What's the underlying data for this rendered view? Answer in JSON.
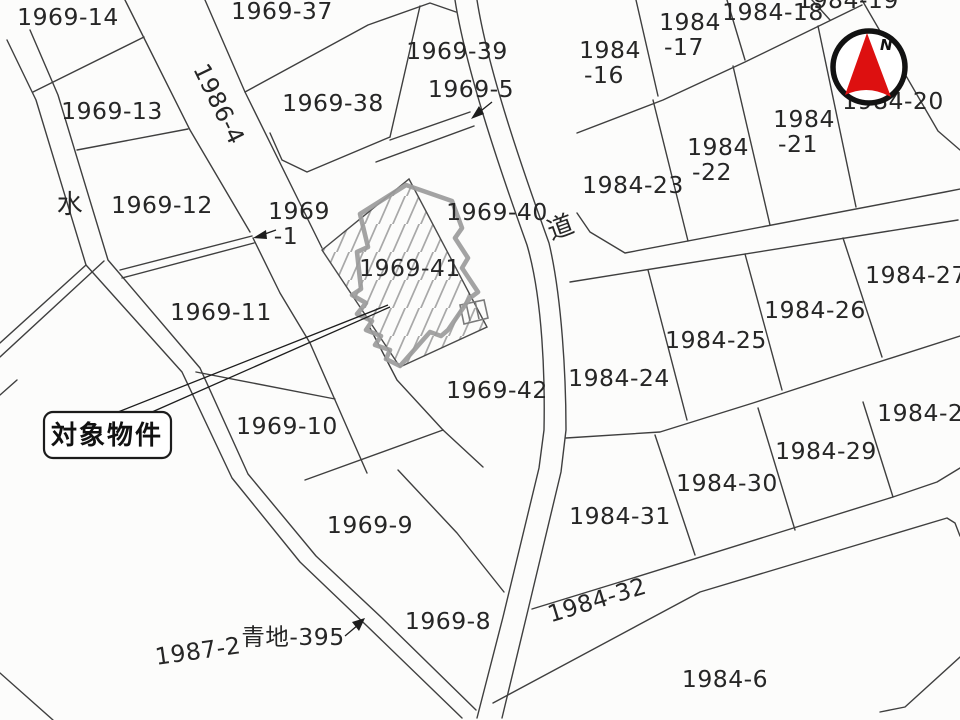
{
  "map": {
    "colors": {
      "background": "#fcfcfb",
      "boundary_line": "#3f3f3f",
      "text": "#262626",
      "property_outline": "#9b9b9b",
      "hatch": "#a8a8a8",
      "compass_ring": "#121212",
      "compass_arrow": "#dd1010"
    },
    "target_parcel": "1969-41",
    "target_callout": {
      "text": "対象物件"
    },
    "compass": {
      "label": "N"
    },
    "labels": [
      {
        "id": "1969-14",
        "text": "1969-14",
        "x": 68,
        "y": 25
      },
      {
        "id": "1969-37",
        "text": "1969-37",
        "x": 282,
        "y": 19
      },
      {
        "id": "1969-39",
        "text": "1969-39",
        "x": 457,
        "y": 59
      },
      {
        "id": "1969-5",
        "text": "1969-5",
        "x": 471,
        "y": 97
      },
      {
        "id": "1984-16",
        "text": "1984\n-16",
        "x": 610,
        "y": 58,
        "dx2": -6
      },
      {
        "id": "1984-17",
        "text": "1984\n-17",
        "x": 690,
        "y": 30,
        "dx2": -6
      },
      {
        "id": "1984-18",
        "text": "1984-18",
        "x": 773,
        "y": 20
      },
      {
        "id": "1984-19",
        "text": "1984-19",
        "x": 848,
        "y": 8
      },
      {
        "id": "1969-13",
        "text": "1969-13",
        "x": 112,
        "y": 119
      },
      {
        "id": "1986-4",
        "text": "1986-4",
        "x": 219,
        "y": 112,
        "rot": 64
      },
      {
        "id": "1969-38",
        "text": "1969-38",
        "x": 333,
        "y": 111
      },
      {
        "id": "1984-23",
        "text": "1984-23",
        "x": 633,
        "y": 193
      },
      {
        "id": "1984-22",
        "text": "1984\n-22",
        "x": 718,
        "y": 155,
        "dx2": -6
      },
      {
        "id": "1984-21",
        "text": "1984\n-21",
        "x": 804,
        "y": 127,
        "dx2": -6
      },
      {
        "id": "1984-20",
        "text": "1984-20",
        "x": 893,
        "y": 109
      },
      {
        "id": "water",
        "text": "水",
        "x": 70,
        "y": 213,
        "size": 27
      },
      {
        "id": "1969-12",
        "text": "1969-12",
        "x": 162,
        "y": 213
      },
      {
        "id": "1969-1",
        "text": "1969\n-1",
        "x": 299,
        "y": 219,
        "dx2": -13
      },
      {
        "id": "1969-40",
        "text": "1969-40",
        "x": 497,
        "y": 220
      },
      {
        "id": "road",
        "text": "道",
        "x": 561,
        "y": 236,
        "rot": -20,
        "size": 24
      },
      {
        "id": "1984-27",
        "text": "1984-27",
        "x": 916,
        "y": 283
      },
      {
        "id": "1984-26",
        "text": "1984-26",
        "x": 815,
        "y": 318
      },
      {
        "id": "1984-25",
        "text": "1984-25",
        "x": 716,
        "y": 348
      },
      {
        "id": "1984-24",
        "text": "1984-24",
        "x": 619,
        "y": 386
      },
      {
        "id": "1969-41",
        "text": "1969-41",
        "x": 410,
        "y": 276
      },
      {
        "id": "1969-11",
        "text": "1969-11",
        "x": 221,
        "y": 320
      },
      {
        "id": "1969-42",
        "text": "1969-42",
        "x": 497,
        "y": 398
      },
      {
        "id": "1969-10",
        "text": "1969-10",
        "x": 287,
        "y": 434
      },
      {
        "id": "1984-28",
        "text": "1984-28",
        "x": 928,
        "y": 421
      },
      {
        "id": "1984-29",
        "text": "1984-29",
        "x": 826,
        "y": 459
      },
      {
        "id": "1984-30",
        "text": "1984-30",
        "x": 727,
        "y": 491
      },
      {
        "id": "1984-31",
        "text": "1984-31",
        "x": 620,
        "y": 524
      },
      {
        "id": "1969-9",
        "text": "1969-9",
        "x": 370,
        "y": 533
      },
      {
        "id": "1984-32",
        "text": "1984-32",
        "x": 597,
        "y": 608,
        "rot": -17
      },
      {
        "id": "1969-8",
        "text": "1969-8",
        "x": 448,
        "y": 629
      },
      {
        "id": "aochi-395",
        "text": "青地-395",
        "x": 293,
        "y": 645
      },
      {
        "id": "1987-2",
        "text": "1987-2",
        "x": 198,
        "y": 659,
        "rot": -8
      },
      {
        "id": "1984-6",
        "text": "1984-6",
        "x": 725,
        "y": 687
      }
    ]
  }
}
